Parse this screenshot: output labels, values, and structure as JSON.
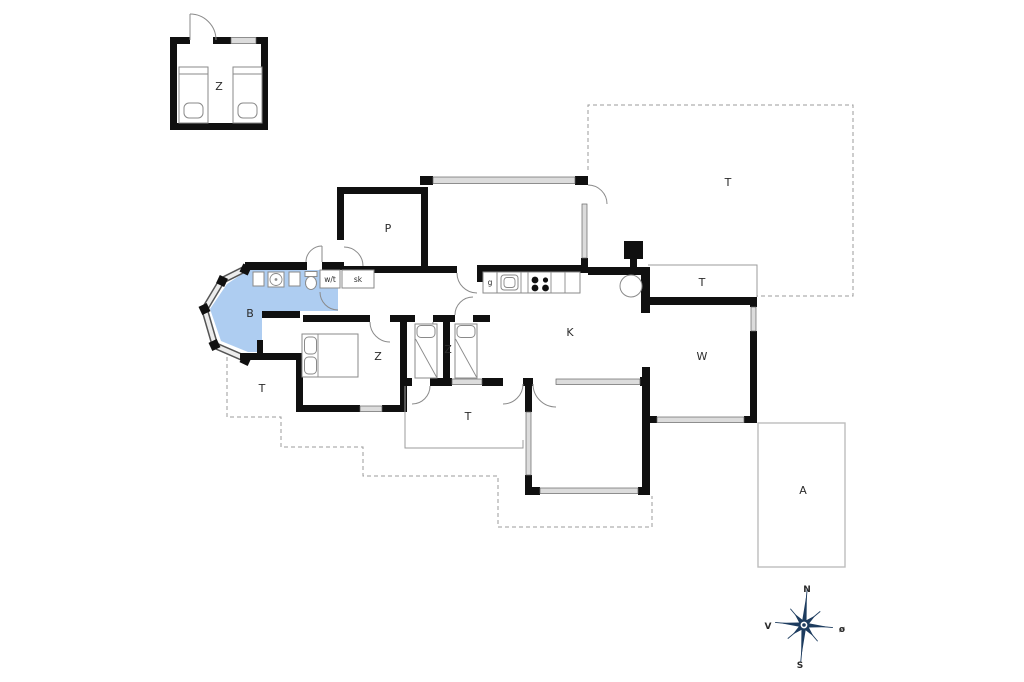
{
  "floor_plan": {
    "labels": {
      "annex_bedroom": "Z",
      "room_p": "P",
      "bathroom": "B",
      "utility": "w/t",
      "closet": "sk",
      "hall": "g",
      "kitchen_living": "K",
      "bedroom_double": "Z",
      "bedroom_twin": "Z",
      "living_room": "W",
      "terrace_covered_ne": "T",
      "terrace_open_ne": "T",
      "terrace_south": "T",
      "terrace_southwest": "T",
      "annex_a": "A"
    },
    "compass": {
      "north": "N",
      "south": "S",
      "west": "V",
      "east": "ø"
    },
    "colors": {
      "bathroom_fill": "#aecdf1",
      "wall": "#101010",
      "window_fill": "#dcdcdc",
      "compass": "#1d3c5f",
      "thin_line": "#9b9b9b"
    }
  }
}
